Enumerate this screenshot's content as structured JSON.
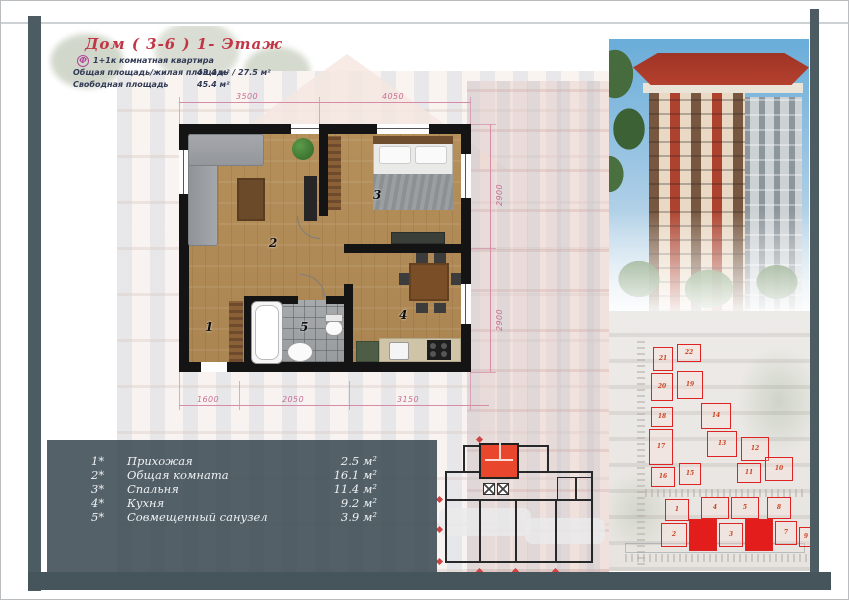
{
  "header": {
    "title": "Дом ( 3-6 )   1- Этаж",
    "logo_glyph": "Ф",
    "subtitle": "1+1к комнатная квартира",
    "total_area_label": "Общая площадь/жилая площадь",
    "total_area_value": "43.4 м²  /  27.5 м²",
    "free_area_label": "Свободная площадь",
    "free_area_value": "45.4 м²"
  },
  "floorplan": {
    "room_numbers": [
      "1",
      "2",
      "3",
      "4",
      "5"
    ],
    "dims": {
      "top": [
        "3500",
        "4050"
      ],
      "right": [
        "2900",
        "2900"
      ],
      "bottom": [
        "1600",
        "2050",
        "3150"
      ]
    }
  },
  "legend": {
    "rows": [
      {
        "num": "1*",
        "name": "Прихожая",
        "area": "2.5 м²"
      },
      {
        "num": "2*",
        "name": "Общая комната",
        "area": "16.1 м²"
      },
      {
        "num": "3*",
        "name": "Спальня",
        "area": "11.4 м²"
      },
      {
        "num": "4*",
        "name": "Кухня",
        "area": "9.2 м²"
      },
      {
        "num": "5*",
        "name": "Совмещенный санузел",
        "area": "3.9 м²"
      }
    ]
  },
  "siteplan": {
    "blocks": [
      {
        "label": "21",
        "filled": false
      },
      {
        "label": "22",
        "filled": false
      },
      {
        "label": "20",
        "filled": false
      },
      {
        "label": "19",
        "filled": false
      },
      {
        "label": "18",
        "filled": false
      },
      {
        "label": "17",
        "filled": false
      },
      {
        "label": "16",
        "filled": false
      },
      {
        "label": "15",
        "filled": false
      },
      {
        "label": "14",
        "filled": false
      },
      {
        "label": "13",
        "filled": false
      },
      {
        "label": "12",
        "filled": false
      },
      {
        "label": "11",
        "filled": false
      },
      {
        "label": "10",
        "filled": false
      },
      {
        "label": "1",
        "filled": false
      },
      {
        "label": "4",
        "filled": false
      },
      {
        "label": "5",
        "filled": false
      },
      {
        "label": "8",
        "filled": false
      },
      {
        "label": "2",
        "filled": false
      },
      {
        "label": "",
        "filled": true
      },
      {
        "label": "3",
        "filled": false
      },
      {
        "label": "",
        "filled": true
      },
      {
        "label": "7",
        "filled": false
      },
      {
        "label": "9",
        "filled": false
      }
    ]
  },
  "colors": {
    "accent_red": "#c13545",
    "dim_pink": "#d4799a",
    "site_red": "#e02222",
    "panel_slate": "#46545c",
    "highlight_red": "#e8472e"
  }
}
